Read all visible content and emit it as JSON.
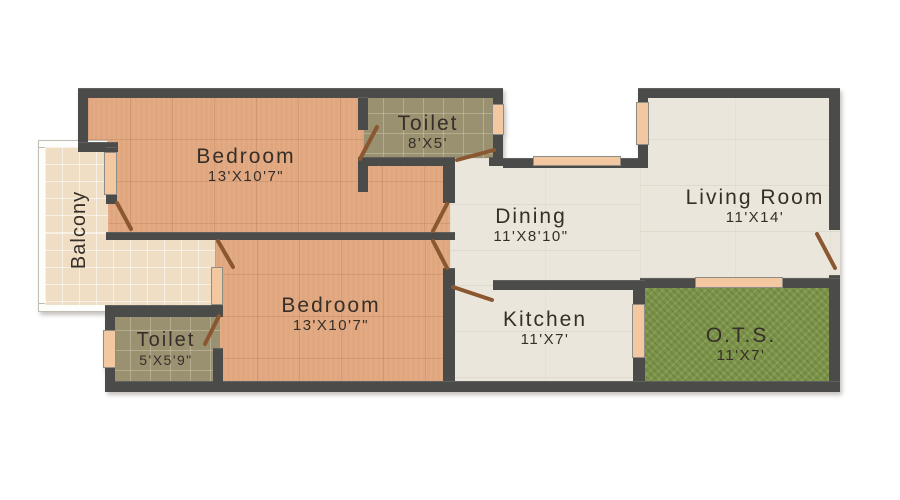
{
  "palette": {
    "wall": "#4b4b49",
    "bedroom_floor": "#e0a67e",
    "toilet_floor": "#9a9171",
    "hall_floor": "#eae6db",
    "balcony_floor": "#efddc4",
    "grass_floor": "#7c9349",
    "door_leaf": "#8a5731",
    "window_fill": "#f3c8a0",
    "label_text": "#362f29"
  },
  "rooms": [
    {
      "id": "bedroom-1",
      "name": "Bedroom",
      "dims": "13'X10'7\""
    },
    {
      "id": "toilet-1",
      "name": "Toilet",
      "dims": "8'X5'"
    },
    {
      "id": "living-room",
      "name": "Living Room",
      "dims": "11'X14'"
    },
    {
      "id": "dining",
      "name": "Dining",
      "dims": "11'X8'10\""
    },
    {
      "id": "bedroom-2",
      "name": "Bedroom",
      "dims": "13'X10'7\""
    },
    {
      "id": "toilet-2",
      "name": "Toilet",
      "dims": "5'X5'9\""
    },
    {
      "id": "kitchen",
      "name": "Kitchen",
      "dims": "11'X7'"
    },
    {
      "id": "ots",
      "name": "O.T.S.",
      "dims": "11'X7'"
    },
    {
      "id": "balcony",
      "name": "Balcony",
      "dims": ""
    }
  ]
}
